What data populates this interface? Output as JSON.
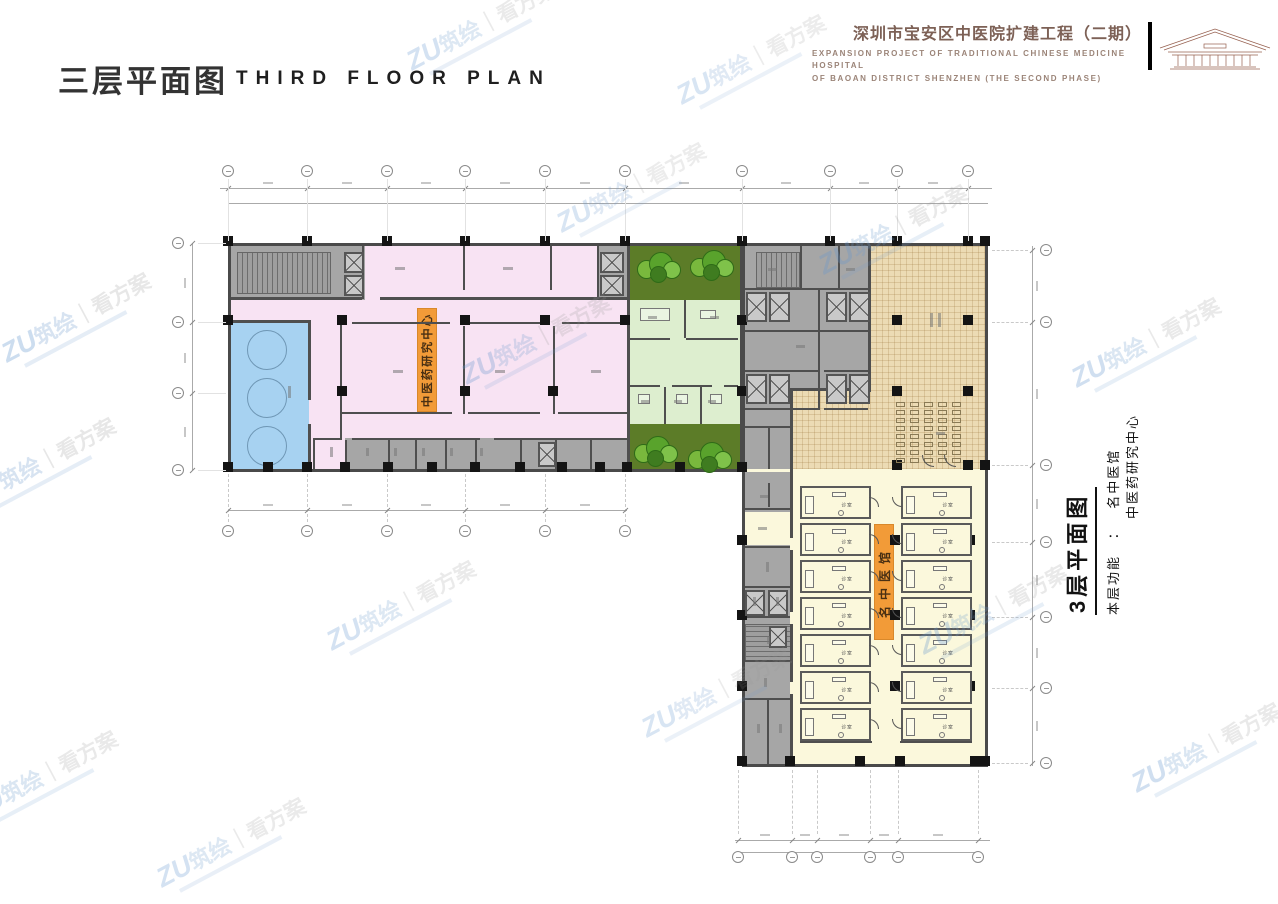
{
  "header": {
    "title_cn": "三层平面图",
    "title_en": "THIRD FLOOR PLAN",
    "project_title_cn": "深圳市宝安区中医院扩建工程（二期）",
    "project_title_en1": "EXPANSION PROJECT OF TRADITIONAL CHINESE MEDICINE HOSPITAL",
    "project_title_en2": "OF BAOAN DISTRICT SHENZHEN (THE SECOND PHASE)"
  },
  "side_note": {
    "title": "3层平面图",
    "function_label": "本层功能",
    "colon": "：",
    "function_line1": "名中医馆",
    "function_line2": "中医药研究中心"
  },
  "plan_labels": {
    "research_center": "中医药研究中心",
    "tcm_clinic": "名中医馆",
    "consult_room": "诊室"
  },
  "watermark": {
    "logo": "ZU",
    "brand": "筑绘",
    "divider": "｜",
    "suffix": "看方案"
  },
  "colors": {
    "accent_orange": "#f29b38",
    "zone_pink": "#f8e3f3",
    "zone_blue": "#a7d2f1",
    "zone_green_dark": "#5c7c28",
    "zone_green_light": "#ddeecf",
    "zone_tan": "#ecdbb4",
    "zone_cream": "#fbf8dc",
    "zone_gray": "#a6a6a6",
    "wall_gray": "#4a4a4a",
    "title_brown": "#7d6156",
    "watermark_blue": "#7fa8d0"
  }
}
